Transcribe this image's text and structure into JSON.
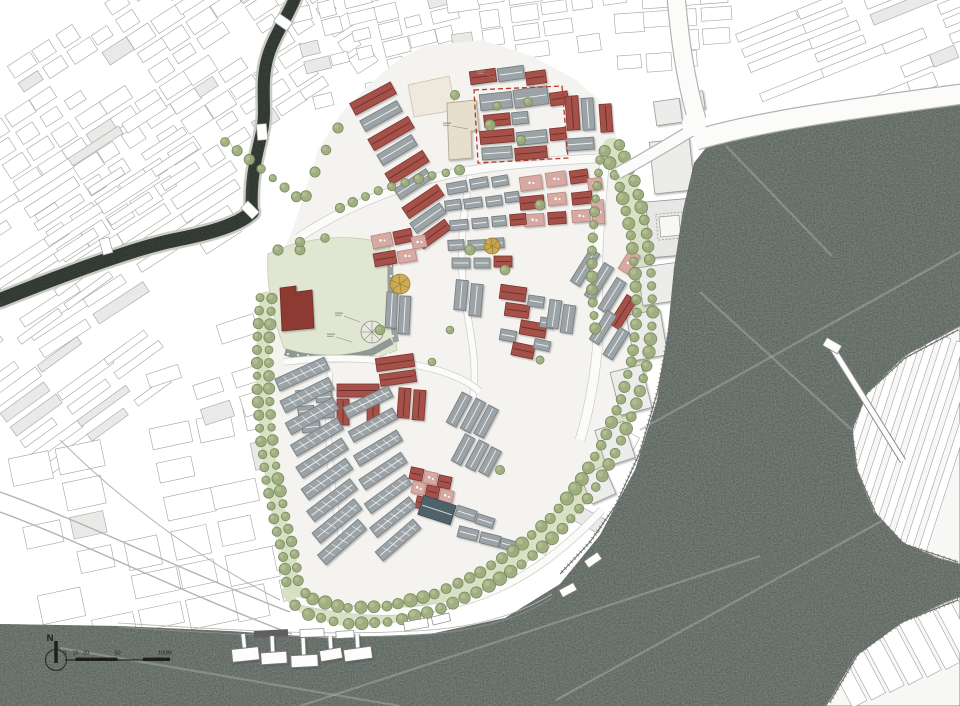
{
  "compass": {
    "label": "N"
  },
  "scale_bar": {
    "labels": [
      "0",
      "10",
      "20",
      "50",
      "100M"
    ]
  },
  "palette": {
    "water": "#78827b",
    "water_streak": "#a6ada4",
    "canal": "#3a423c",
    "canal_bank": "#c8ccc3",
    "ground": "#f4f3ef",
    "lawn": "#e0e6d2",
    "lawn_edge": "#c2cbb0",
    "boulevard_green": "#d6dfc0",
    "tree": "#9cab7c",
    "tree_edge": "#74865b",
    "accent_tree": "#c8a547",
    "roof_red": "#a5514a",
    "roof_red_dark": "#7d352e",
    "roof_maroon": "#8d3a31",
    "roof_pink": "#d6aaa3",
    "roof_pink_edge": "#b9897f",
    "roof_gray": "#9ba3a7",
    "roof_gray_dark": "#747c80",
    "roof_teal": "#50626b",
    "building_cream": "#e7dfcb",
    "building_plaza": "#eee9dc",
    "context_line": "#a3a3a1",
    "context_fill_light": "#e9e9e7",
    "road_white": "#fbfbfa",
    "road_casing": "#b2b2b0",
    "shore_line": "#6f6f6d",
    "boundary_dashed": "#b43a2c",
    "ink": "#2b2b2b"
  }
}
